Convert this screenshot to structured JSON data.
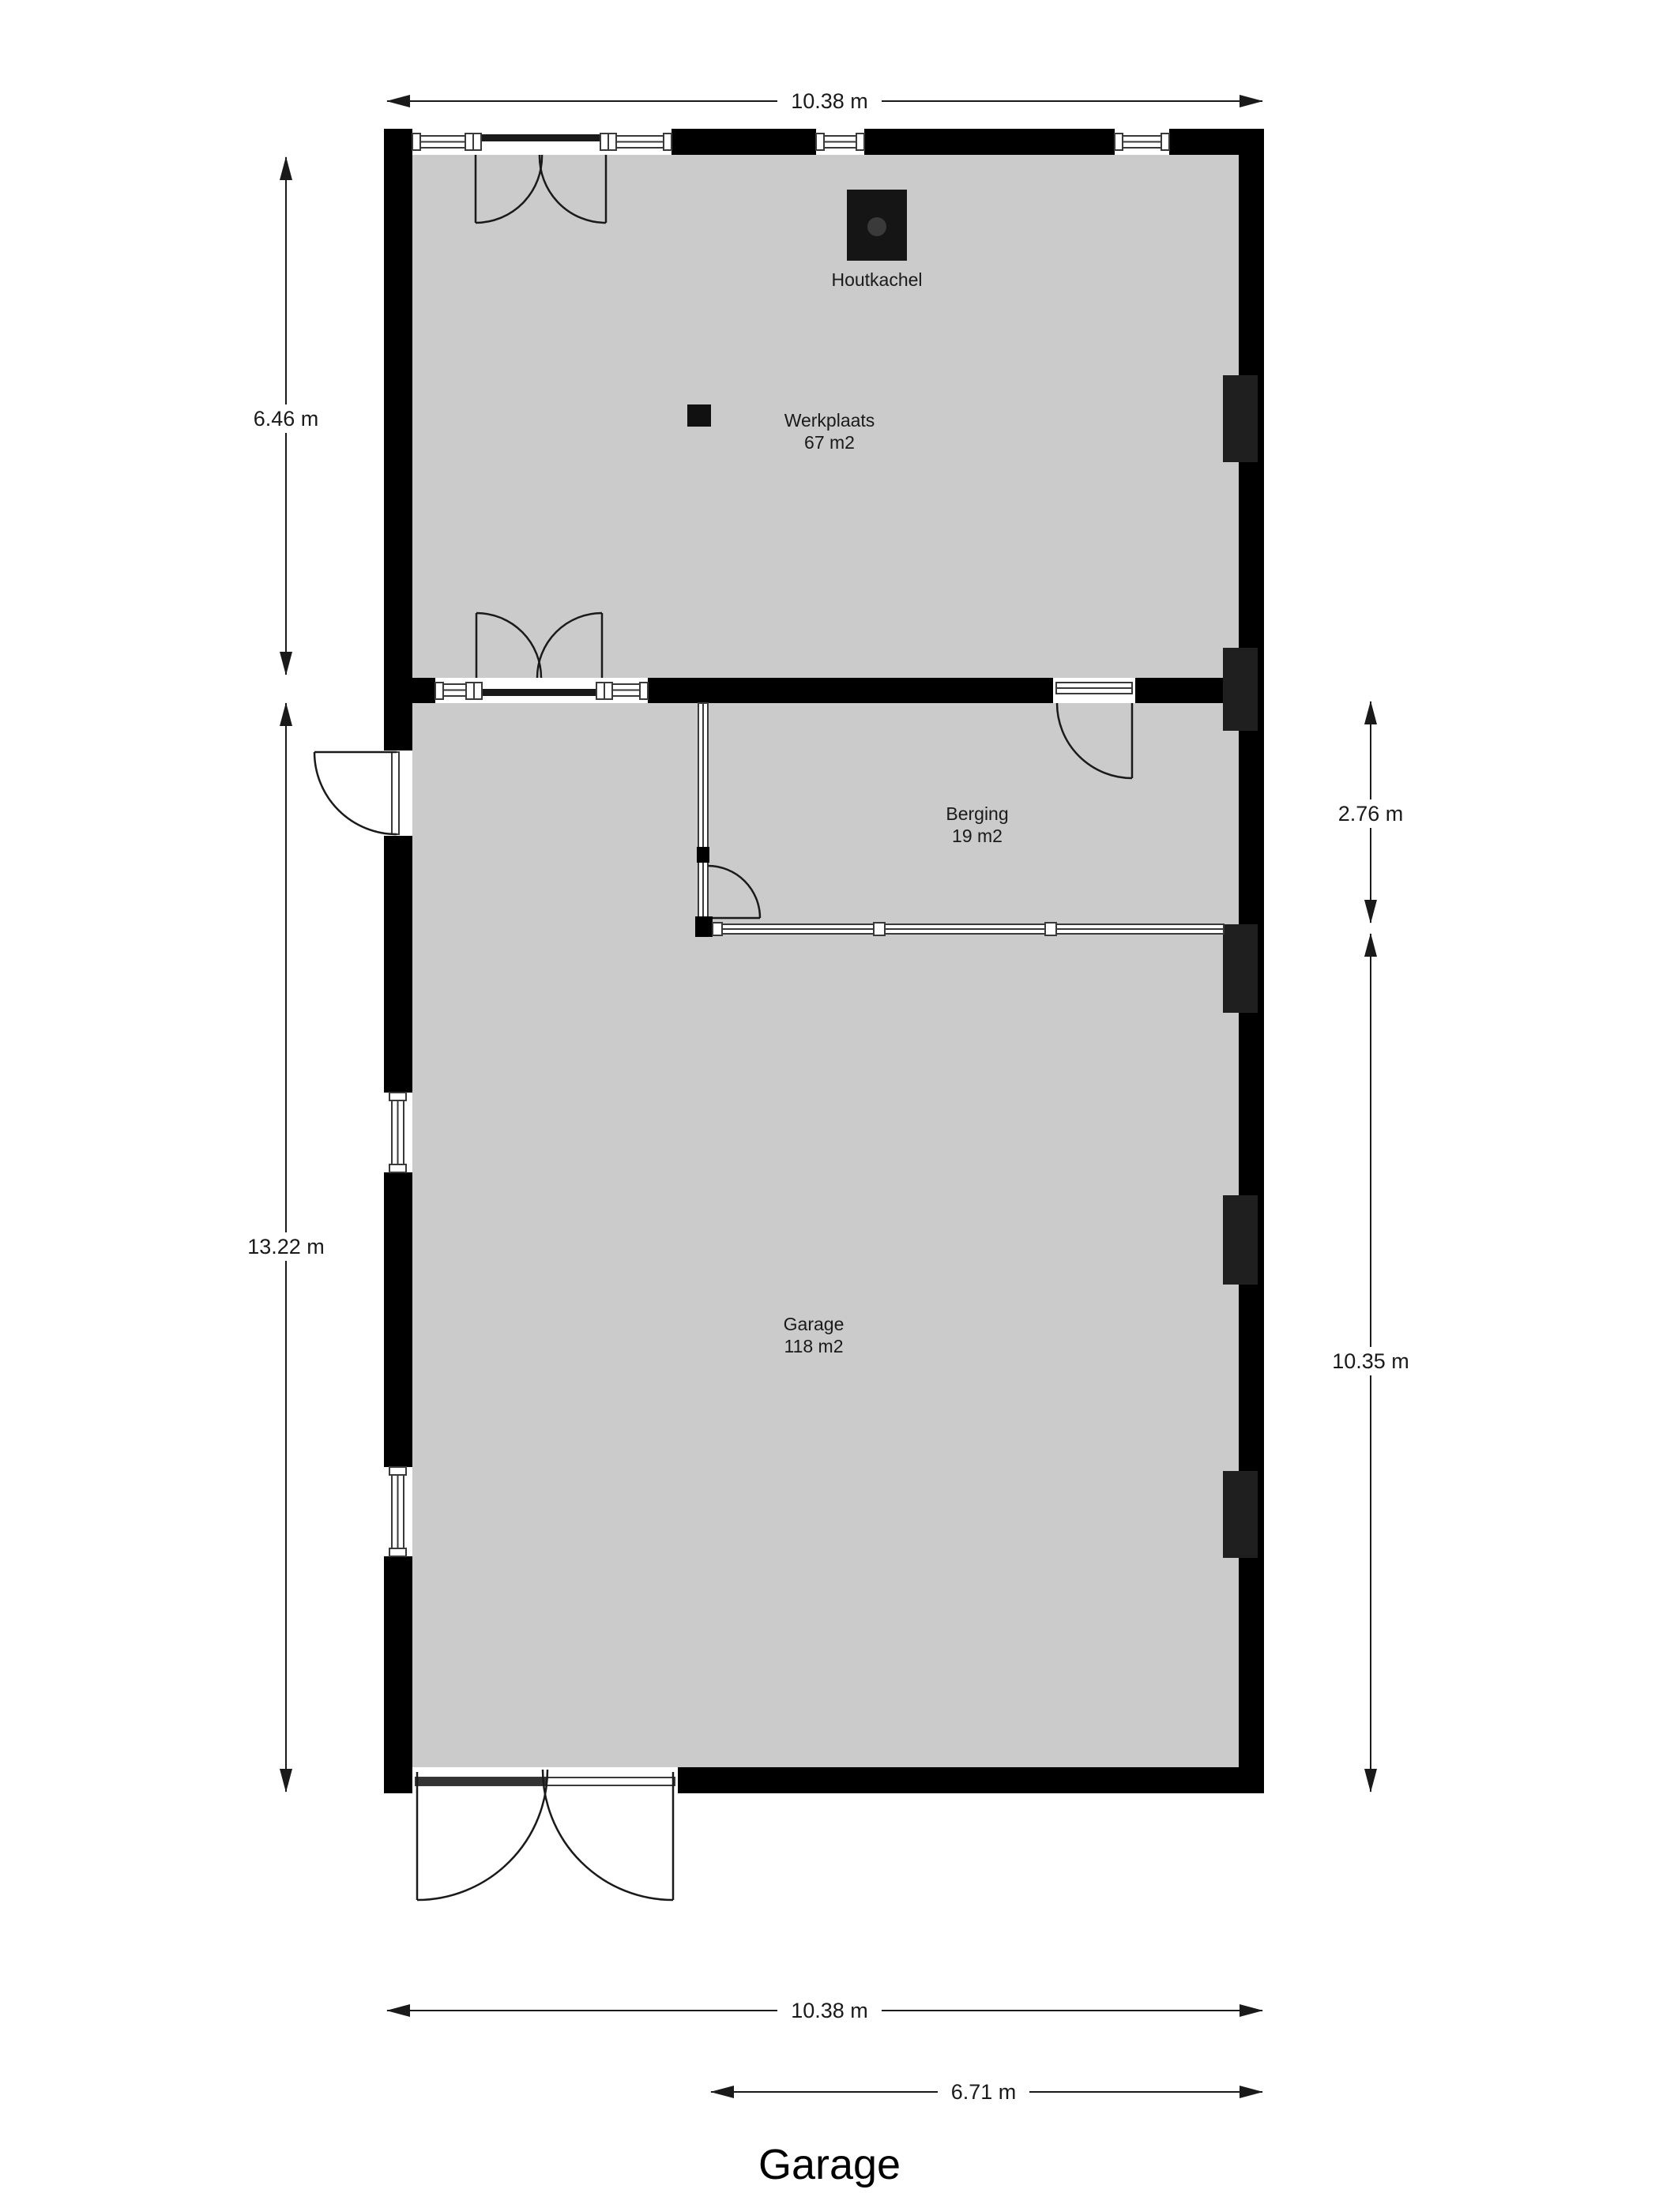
{
  "title": "Garage",
  "rooms": {
    "werkplaats": {
      "name": "Werkplaats",
      "area": "67 m2"
    },
    "berging": {
      "name": "Berging",
      "area": "19 m2"
    },
    "garage": {
      "name": "Garage",
      "area": "118 m2"
    }
  },
  "fixtures": {
    "stove": {
      "label": "Houtkachel"
    }
  },
  "dimensions": {
    "top_width": "10.38 m",
    "left_upper": "6.46 m",
    "left_lower": "13.22 m",
    "right_upper": "2.76 m",
    "right_lower": "10.35 m",
    "bottom_width": "10.38 m",
    "bottom_garage_section": "6.71 m"
  },
  "colors": {
    "wall": "#000000",
    "floor": "#cbcbcb",
    "pilaster": "#1f1f1f",
    "dimension": "#1a1a1a"
  }
}
